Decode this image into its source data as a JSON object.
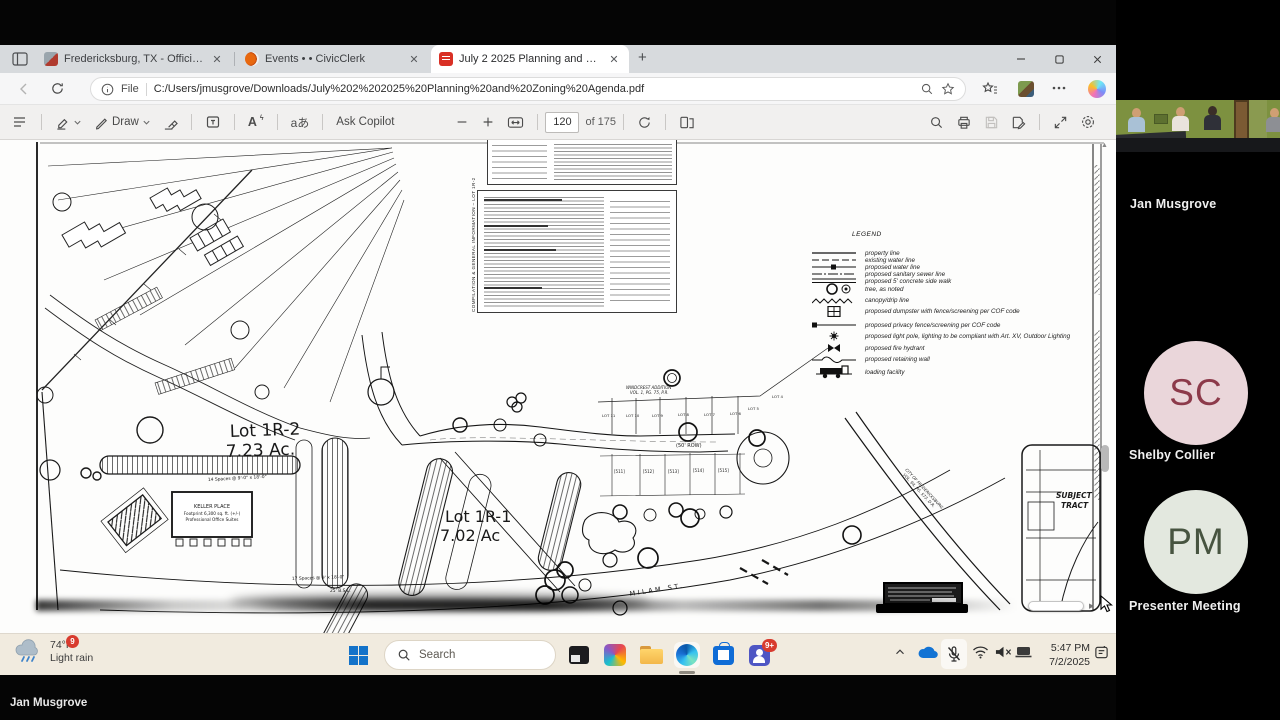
{
  "meeting": {
    "speaker_overlay": "Jan Musgrove",
    "participants": [
      {
        "name": "Jan Musgrove",
        "type": "video"
      },
      {
        "name": "Shelby Collier",
        "initials": "SC",
        "avatar_bg": "#ead6da",
        "initial_color": "#8c3a4a"
      },
      {
        "name": "Presenter Meeting",
        "initials": "PM",
        "avatar_bg": "#e3e8df",
        "initial_color": "#475440"
      }
    ]
  },
  "browser": {
    "tabs": [
      {
        "title": "Fredericksburg, TX - Official Web…",
        "close": "✕"
      },
      {
        "title": "Events • • CivicClerk",
        "close": "✕"
      },
      {
        "title": "July 2 2025 Planning and Zoning",
        "close": "✕"
      }
    ],
    "new_tab": "+",
    "address": {
      "prefix": "File",
      "url": "C:/Users/jmusgrove/Downloads/July%202%202025%20Planning%20and%20Zoning%20Agenda.pdf"
    }
  },
  "pdf_toolbar": {
    "draw_label": "Draw",
    "ask_copilot": "Ask Copilot",
    "page_current": "120",
    "page_total": "of 175",
    "translate_label": "aあ",
    "read_aloud_label": "A"
  },
  "document": {
    "side_note_label": "COMPILATION & GENERAL INFORMATION – LOT 1R-2",
    "legend": {
      "title": "LEGEND",
      "items": [
        {
          "symbol": "property-line",
          "label": "property line"
        },
        {
          "symbol": "existing-water-line",
          "label": "existing water line"
        },
        {
          "symbol": "proposed-water-line",
          "label": "proposed water line"
        },
        {
          "symbol": "proposed-sewer-line",
          "label": "proposed sanitary sewer line"
        },
        {
          "symbol": "sidewalk",
          "label": "proposed 5' concrete side walk"
        },
        {
          "symbol": "tree",
          "label": "tree, as noted"
        },
        {
          "symbol": "canopy-line",
          "label": "canopy/drip line"
        },
        {
          "symbol": "dumpster",
          "label": "proposed dumpster with fence/screening per COF code"
        },
        {
          "symbol": "privacy-fence",
          "label": "proposed privacy fence/screening per COF code"
        },
        {
          "symbol": "light-pole",
          "label": "proposed light pole, lighting to be compliant with Art. XV, Outdoor Lighting"
        },
        {
          "symbol": "fire-hydrant",
          "label": "proposed fire hydrant"
        },
        {
          "symbol": "retaining-wall",
          "label": "proposed retaining wall"
        },
        {
          "symbol": "loading-facility",
          "label": "loading facility"
        }
      ]
    },
    "labels": {
      "lot1r2": "Lot 1R-2",
      "lot1r2_area": "7.23 Ac.",
      "lot1r1": "Lot 1R-1",
      "lot1r1_area": "7.02 Ac",
      "building1": "KELLER  PLACE",
      "building2": "Footprint 6,300 sq. ft. (+/-)",
      "building3": "Professional Office Suites",
      "windcrest1": "WINDCREST ADDITION",
      "windcrest2": "VOL. 1, PG. 75, P.R.",
      "row_label": "(50' ROW)",
      "lots": [
        "LOT 11",
        "LOT 10",
        "LOT 9",
        "LOT 8",
        "LOT 7",
        "LOT 6",
        "LOT 5",
        "LOT 4"
      ],
      "addresses": [
        "[511]",
        "[512]",
        "[513]",
        "[514]",
        "[515]"
      ],
      "city_ref1": "CITY OF FREDERICKSBURG",
      "city_ref2": "VOL. 94, PG. 573, D.R.",
      "subject1": "SUBJECT",
      "subject2": "TRACT",
      "street": "MILAM  ST.",
      "spaces14": "14 Spaces @ 9'-0\" x 18'-0\"",
      "spaces17": "17 Spaces @ 9' x 18'-0\"",
      "bsl": "25' B.S.L."
    }
  },
  "taskbar": {
    "weather_badge": "9",
    "weather_temp": "74°F",
    "weather_desc": "Light rain",
    "search_placeholder": "Search",
    "teams_badge": "9+",
    "time": "5:47 PM",
    "date": "7/2/2025"
  }
}
